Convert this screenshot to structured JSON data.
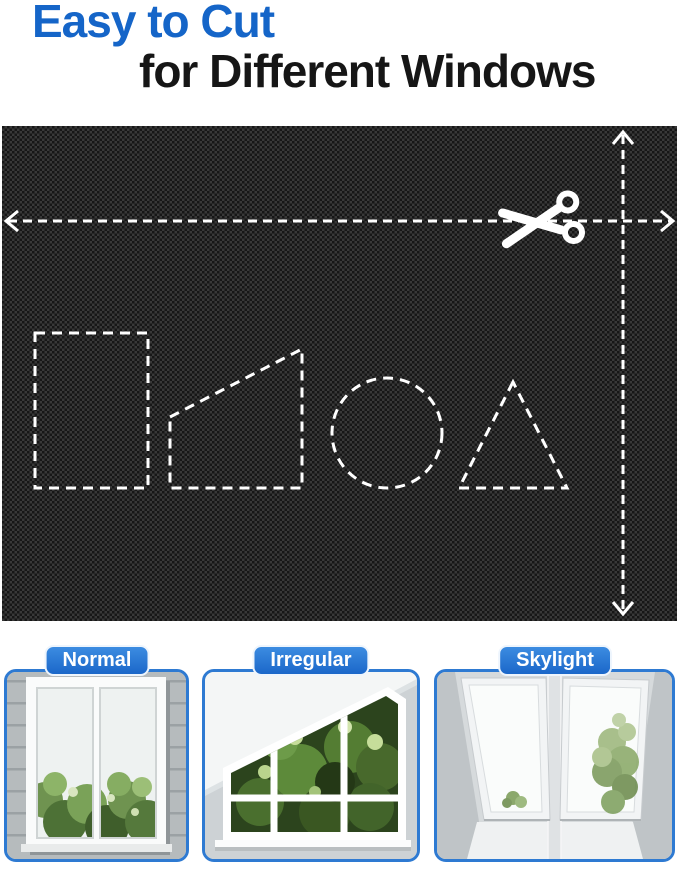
{
  "header": {
    "title_line1": "Easy to Cut",
    "title_line2": "for Different Windows",
    "title_accent_color": "#1565c8",
    "title_text_color": "#161616"
  },
  "fabric_panel": {
    "fabric_color": "#1a1a1a",
    "dash_color": "#ffffff",
    "icons": [
      "scissors-icon",
      "double-arrow-horizontal-icon",
      "double-arrow-vertical-icon"
    ],
    "cut_shapes": [
      "rectangle",
      "right-trapezoid",
      "circle",
      "triangle"
    ]
  },
  "window_types": [
    {
      "label": "Normal"
    },
    {
      "label": "Irregular"
    },
    {
      "label": "Skylight"
    }
  ],
  "colors": {
    "label_pill_blue": "#1e6fd0",
    "card_border_blue": "#2e7ad2",
    "page_background": "#ffffff"
  }
}
